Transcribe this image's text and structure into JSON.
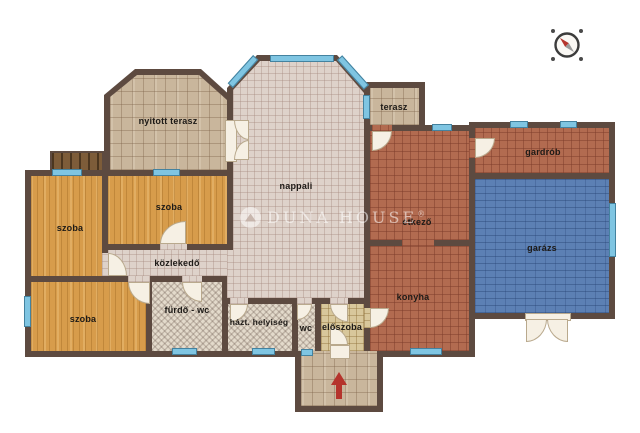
{
  "plan": {
    "title": "floor-plan",
    "rooms": {
      "nyitott_terasz": {
        "label": "nyitott terasz"
      },
      "szoba_1": {
        "label": "szoba"
      },
      "szoba_2": {
        "label": "szoba"
      },
      "szoba_3": {
        "label": "szoba"
      },
      "nappali": {
        "label": "nappali"
      },
      "kozlekedo": {
        "label": "közlekedő"
      },
      "furdo_wc": {
        "label": "fürdő - wc"
      },
      "hazt_helyiseg": {
        "label": "házt. helyiség"
      },
      "wc": {
        "label": "wc"
      },
      "eloszoba": {
        "label": "előszoba"
      },
      "konyha": {
        "label": "konyha"
      },
      "etkezo": {
        "label": "étkező"
      },
      "terasz": {
        "label": "terasz"
      },
      "gardrob": {
        "label": "gardrób"
      },
      "garazs": {
        "label": "garázs"
      }
    },
    "watermark": {
      "brand": "Duna House",
      "reg": "®"
    },
    "colors": {
      "wall": "#5d4a40",
      "window": "#7fc5e2",
      "wood_floor": "#d79c4b",
      "living_floor": "#ded2ca",
      "warm_tile": "#b26b50",
      "garage_blue": "#5c80b4",
      "bath_tile": "#e3dacb",
      "hall_tile": "#d8c79b",
      "terrace_block": "#c9b69c",
      "entrance_arrow": "#b5342c"
    }
  }
}
